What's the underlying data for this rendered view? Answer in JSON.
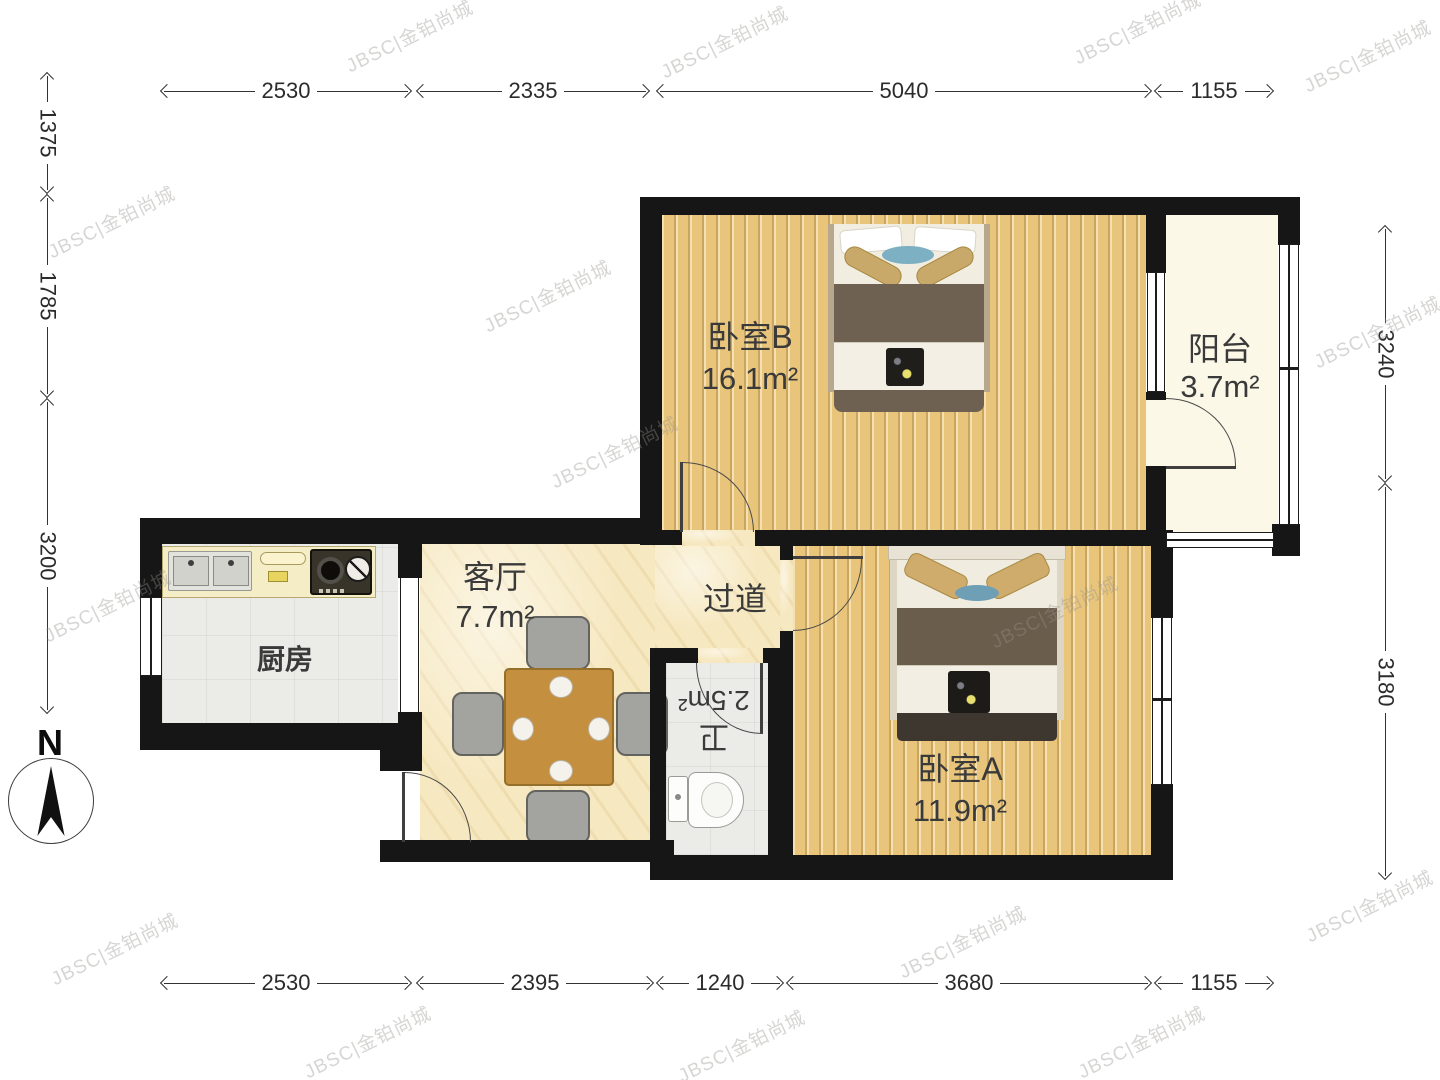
{
  "plan": {
    "rooms": {
      "bedroom_b": {
        "name": "卧室B",
        "area": "16.1m²"
      },
      "balcony": {
        "name": "阳台",
        "area": "3.7m²"
      },
      "living": {
        "name": "客厅",
        "area": "7.7m²"
      },
      "hallway": {
        "name": "过道"
      },
      "kitchen": {
        "name": "厨房"
      },
      "bath": {
        "name": "卫",
        "area": "2.5m²"
      },
      "bedroom_a": {
        "name": "卧室A",
        "area": "11.9m²"
      }
    },
    "dimensions": {
      "top": [
        "2530",
        "2335",
        "5040",
        "1155"
      ],
      "bottom": [
        "2530",
        "2395",
        "1240",
        "3680",
        "1155"
      ],
      "left": [
        "1375",
        "1785",
        "3200"
      ],
      "right": [
        "3240",
        "3180"
      ]
    },
    "compass": {
      "label": "N"
    },
    "watermark": {
      "text": "JBSC|金铂尚城"
    },
    "colors": {
      "wall": "#161616",
      "wood": "#e9c57c",
      "marble": "#f6e8c0",
      "tile": "#ebebe7",
      "balcony": "#fbf8e7"
    }
  }
}
